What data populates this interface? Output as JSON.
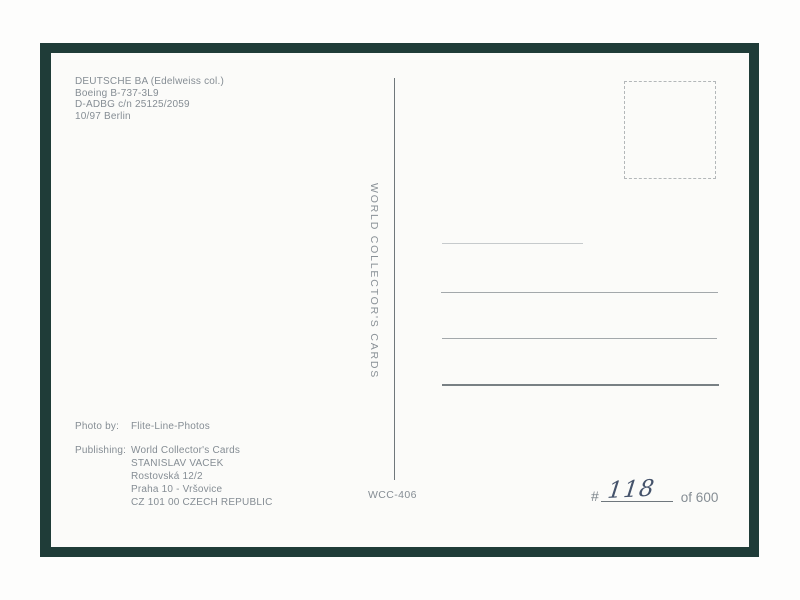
{
  "postcard": {
    "aircraft_info": {
      "lines": [
        "DEUTSCHE BA (Edelweiss col.)",
        "Boeing B-737-3L9",
        "D-ADBG c/n 25125/2059",
        "10/97 Berlin"
      ]
    },
    "brand_vertical_text": "WORLD COLLECTOR'S CARDS",
    "credits": {
      "photo_label": "Photo by:",
      "photo_value": "Flite-Line-Photos",
      "publishing_label": "Publishing:",
      "publishing_lines": [
        "World Collector's Cards",
        "STANISLAV VACEK",
        "Rostovská 12/2",
        "Praha 10 - Vršovice",
        "CZ 101 00 CZECH REPUBLIC"
      ]
    },
    "card_code": "WCC-406",
    "edition": {
      "hash": "#",
      "handwritten_number": "118",
      "of_total": "of 600"
    },
    "colors": {
      "card_border": "#1f3c38",
      "printed_ink": "#858d94",
      "handwriting_ink": "#45536b",
      "card_background": "#fbfbf9"
    }
  }
}
